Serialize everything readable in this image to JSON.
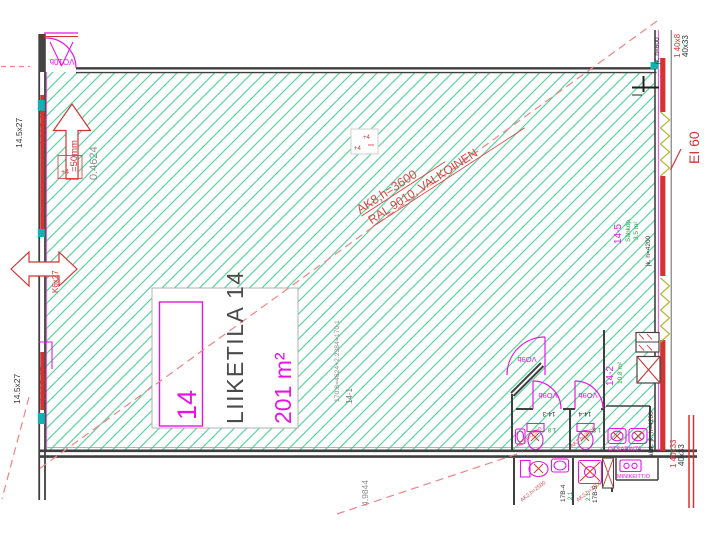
{
  "labels": {
    "room_box": "14",
    "room_title": "LIIKETILA 14",
    "room_area": "201 m²",
    "ceiling1": "AK8,h=3600",
    "ceiling2": "RAL 9010, VALKOINEN",
    "vo10b": "VO10b",
    "vo9b": "VO9b",
    "win_145_red": "1 14.5x27",
    "win_145": "14.5x27",
    "win_k6": "K6x27",
    "win_408_red": "1 40x8",
    "win_4033_red": "1 40x33",
    "win_4033": "40x33",
    "ei60": "EI 60",
    "arrow_note": "=50mm",
    "plus4": "+4",
    "dim_04624": "0.4624",
    "calc": "170.8=4624+2.2384=170.1",
    "r14_1": "14-1",
    "dim_49844": "4.9844",
    "r14_2": "14-2",
    "a14_2": "10.8 m²",
    "r14_3": "14-3",
    "r14_4": "14-4",
    "wc_note": "AK2,h=2500",
    "wc_area": "1.8",
    "r14_5": "14-5",
    "n14_5": "Sähköp.",
    "a14_5": "3.5 m²",
    "r17b4": "17B-4",
    "r17b5": "17B-5",
    "a17b": "2.1",
    "jk600": "jk, h=600",
    "jk4200": "jk, h=4200",
    "alak4200": "alak. jk, h=4200",
    "otsapinta": "OTSAPINTA",
    "minikeittio": "MINIKEITTIÖ"
  },
  "colors": {
    "hatch_green": "#5ad6a2",
    "magenta": "#e516e5",
    "red": "#d23333",
    "dashed_red": "#ee8585",
    "dark_wall": "#3f3f3f",
    "teal": "#14b0b4",
    "gray_text": "#8c8c8c",
    "olive_zigzag": "#b5b535",
    "green_text": "#21a447"
  }
}
